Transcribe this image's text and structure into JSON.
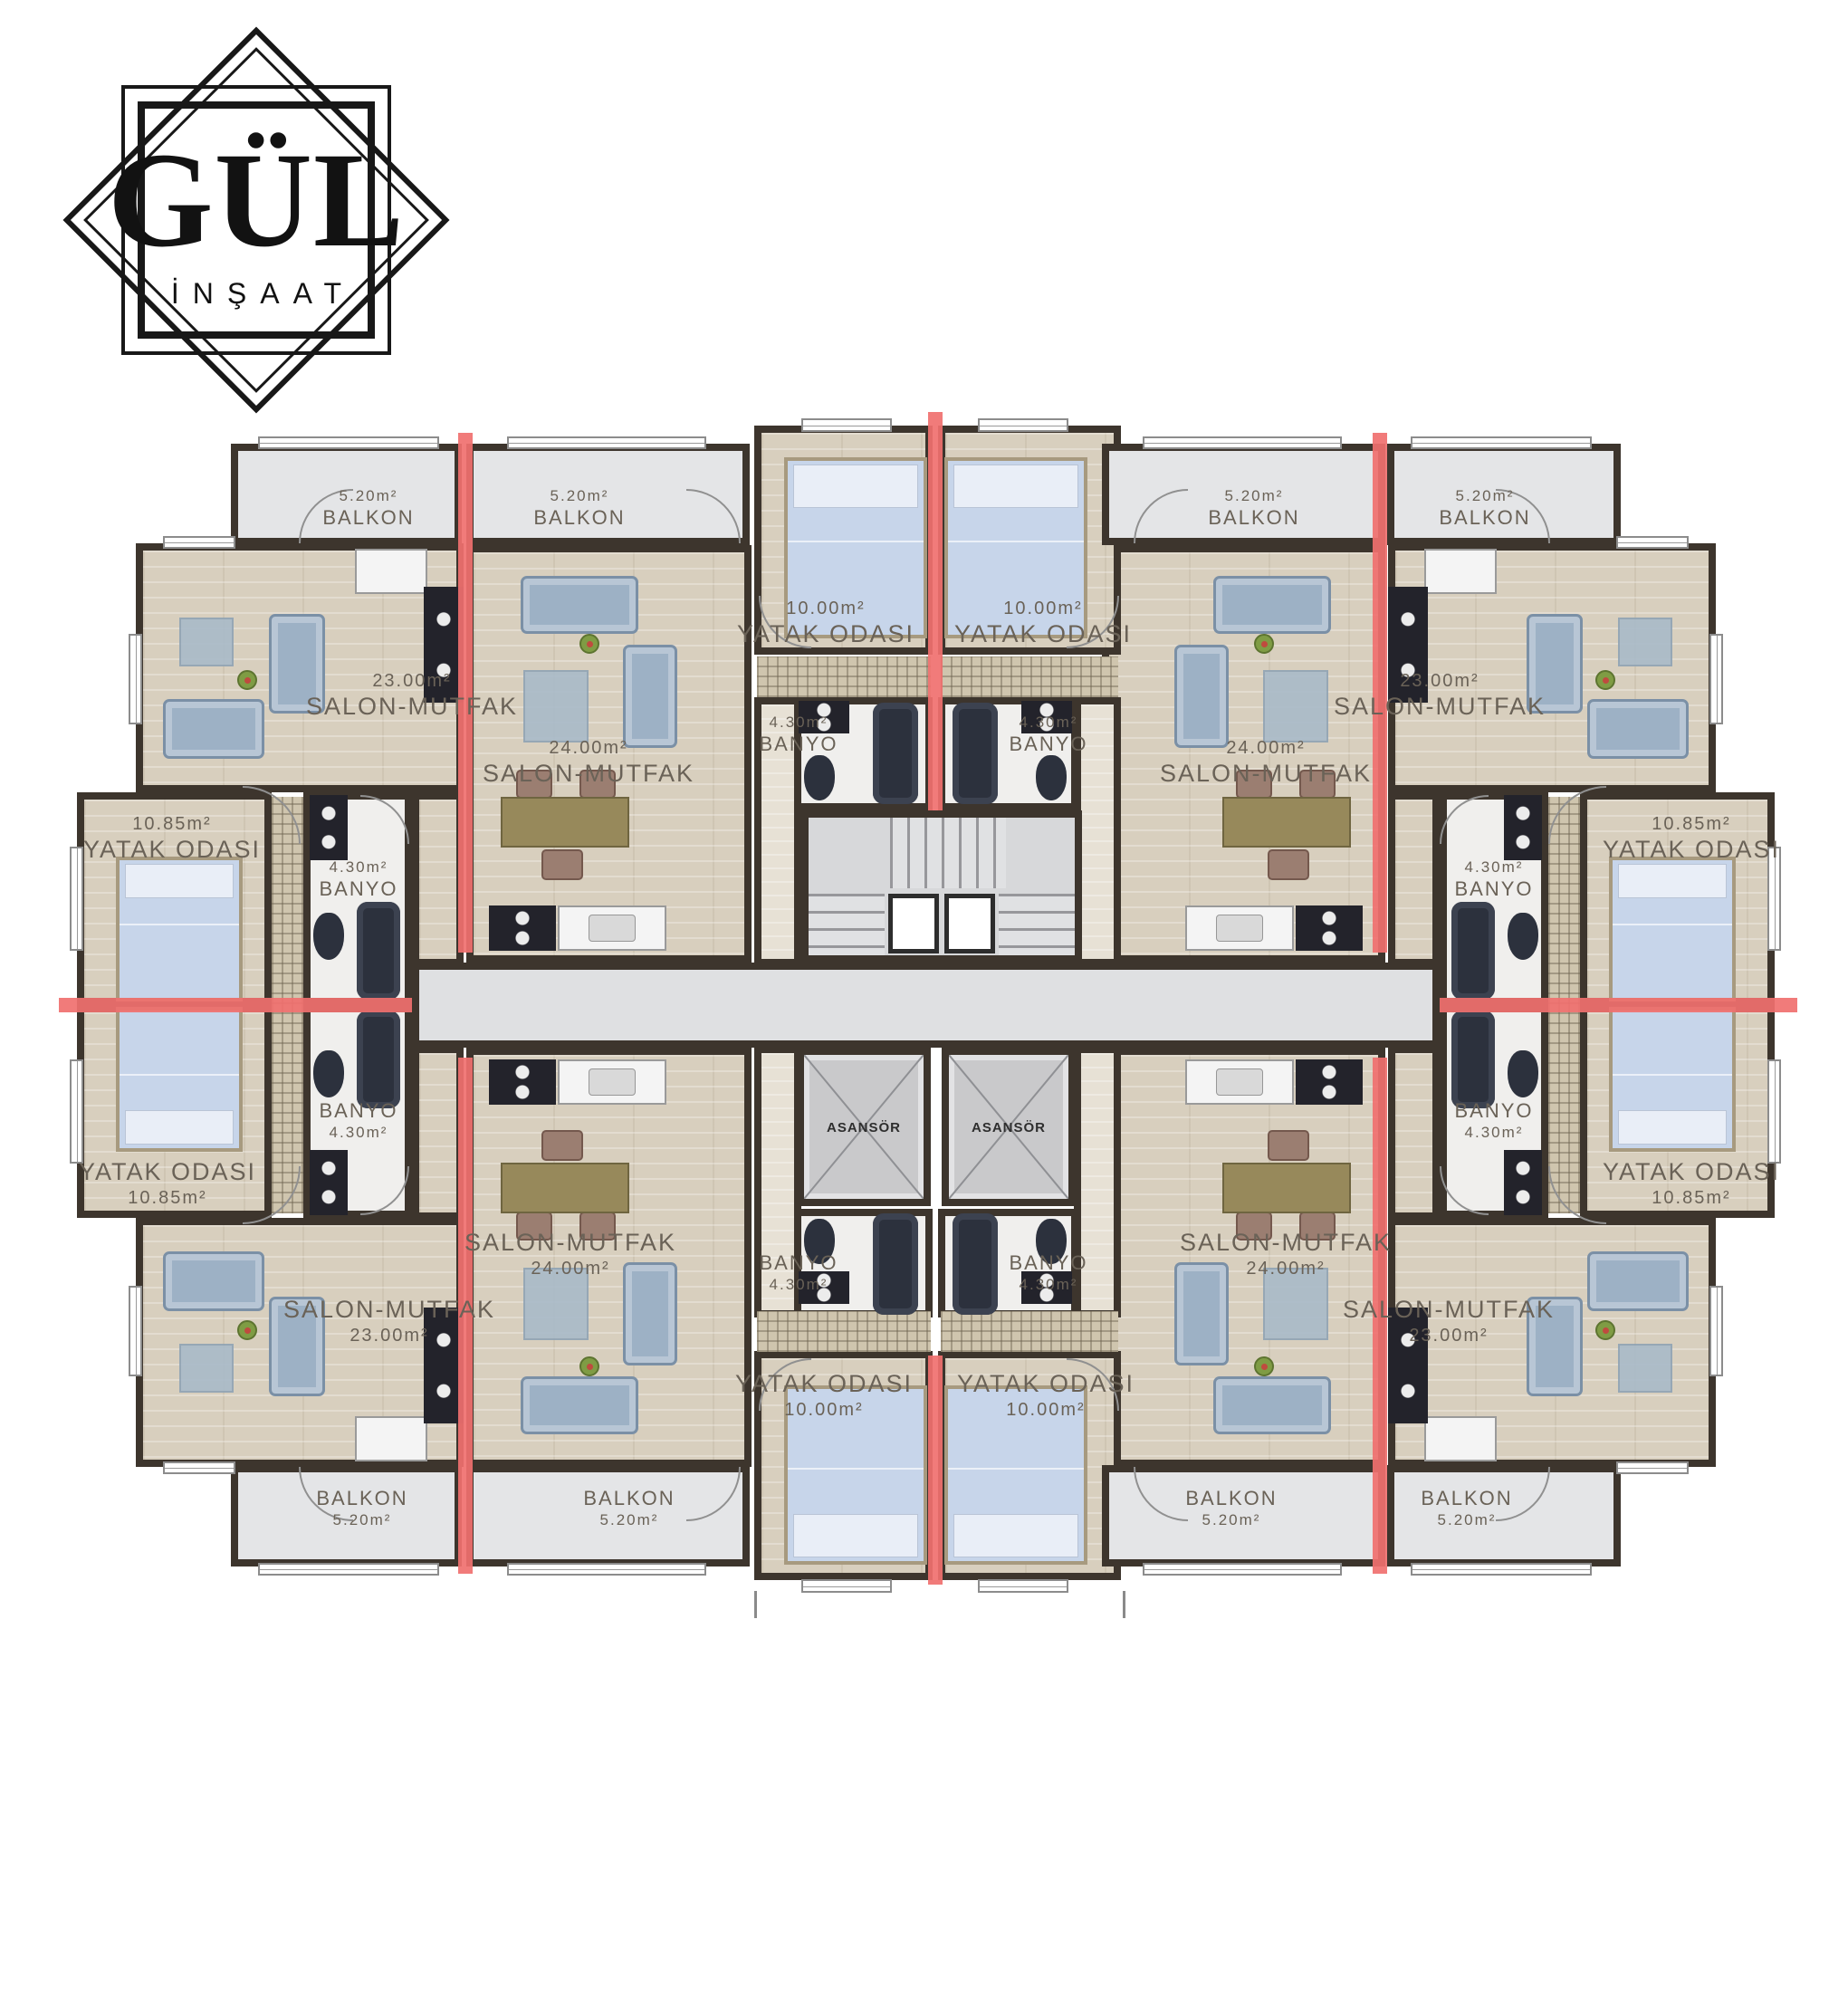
{
  "logo": {
    "title": "GÜL",
    "subtitle": "İNŞAAT"
  },
  "room_types": {
    "balkon": {
      "name": "BALKON",
      "area": "5.20m²"
    },
    "salon_corner": {
      "name": "SALON-MUTFAK",
      "area": "23.00m²"
    },
    "salon_inner": {
      "name": "SALON-MUTFAK",
      "area": "24.00m²"
    },
    "yatak_wing": {
      "name": "YATAK ODASI",
      "area": "10.85m²"
    },
    "yatak_center": {
      "name": "YATAK ODASI",
      "area": "10.00m²"
    },
    "banyo": {
      "name": "BANYO",
      "area": "4.30m²"
    },
    "asansor": {
      "name": "ASANSÖR"
    }
  },
  "colors": {
    "wall": "#3d352d",
    "divider_red": "#f0706f",
    "wood_floor": "#d8cfbe",
    "balcony_gray": "#e4e5e7",
    "corridor_gray": "#dfe0e2",
    "bath_white": "#f0efed",
    "fixture_dark": "#2c313d",
    "bed_blue": "#c7d5ea",
    "sofa_blue": "#9db1c5"
  }
}
